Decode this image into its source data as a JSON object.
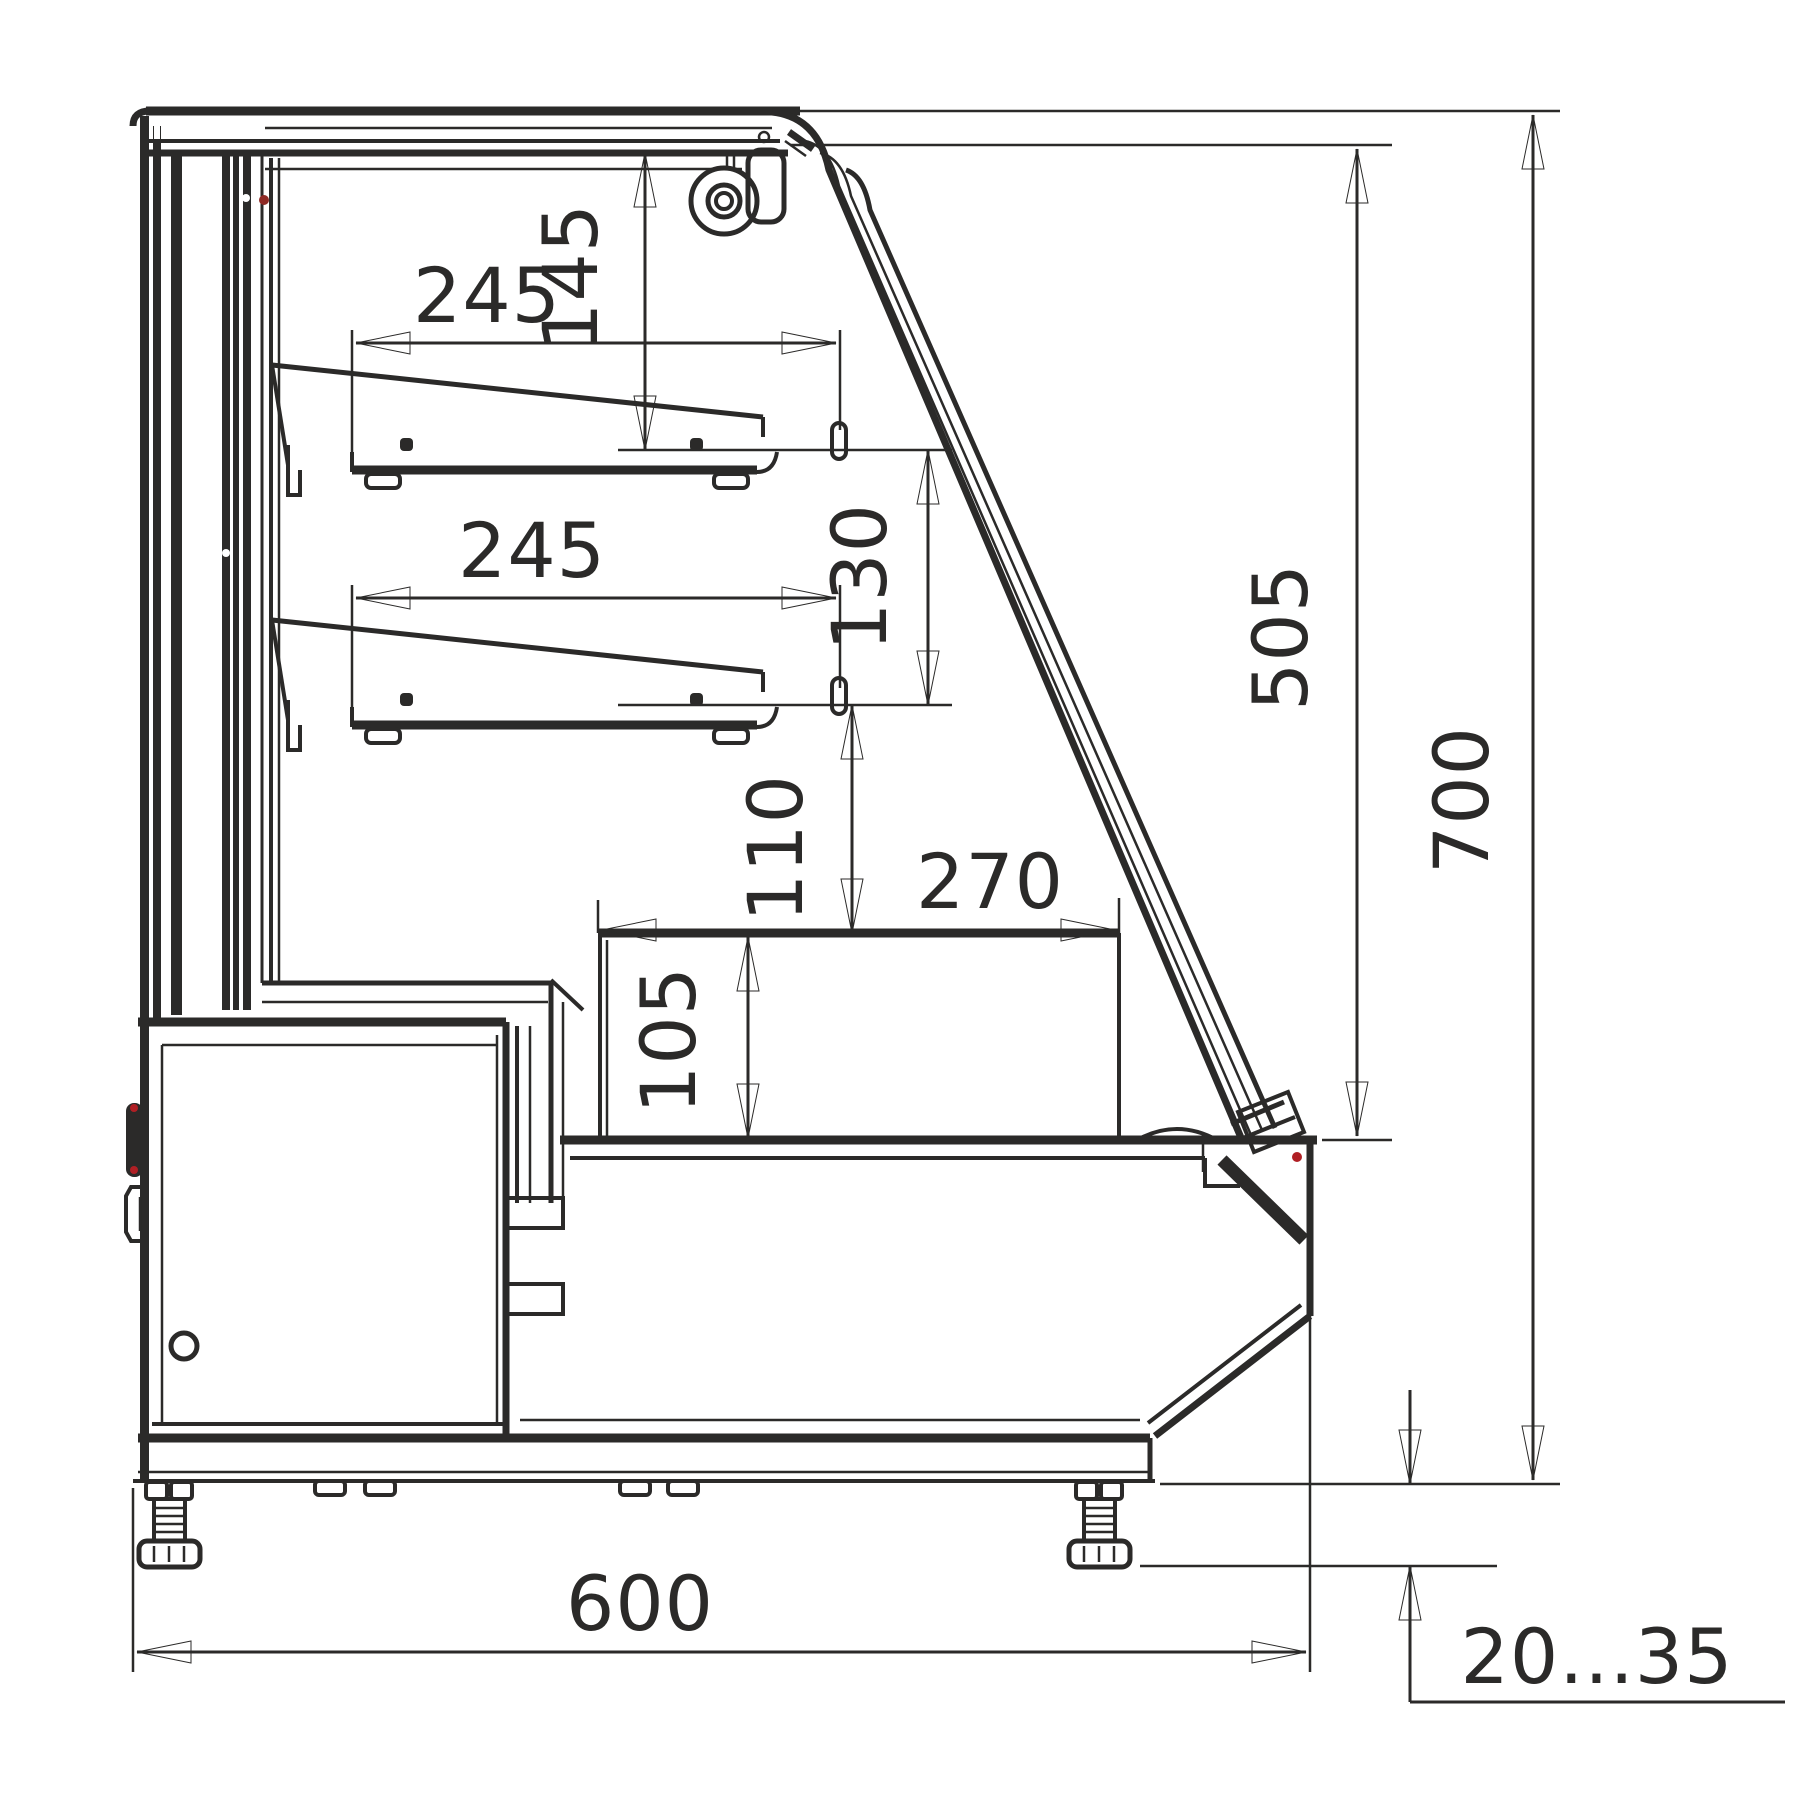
{
  "drawing": {
    "type": "technical-cross-section",
    "subject": "refrigerated-display-case-side-view",
    "units": "mm",
    "dimensions": {
      "shelf1_width": "245",
      "canopy_to_shelf1": "145",
      "shelf2_width": "245",
      "shelf1_to_shelf2": "130",
      "shelf2_to_deck": "110",
      "deck_width": "270",
      "deck_height": "105",
      "glass_opening_height": "505",
      "total_height": "700",
      "total_depth": "600",
      "foot_adjust_range": "20...35"
    },
    "colors": {
      "line": "#2b2a29",
      "accent_red": "#b01f24",
      "background": "#ffffff"
    }
  }
}
